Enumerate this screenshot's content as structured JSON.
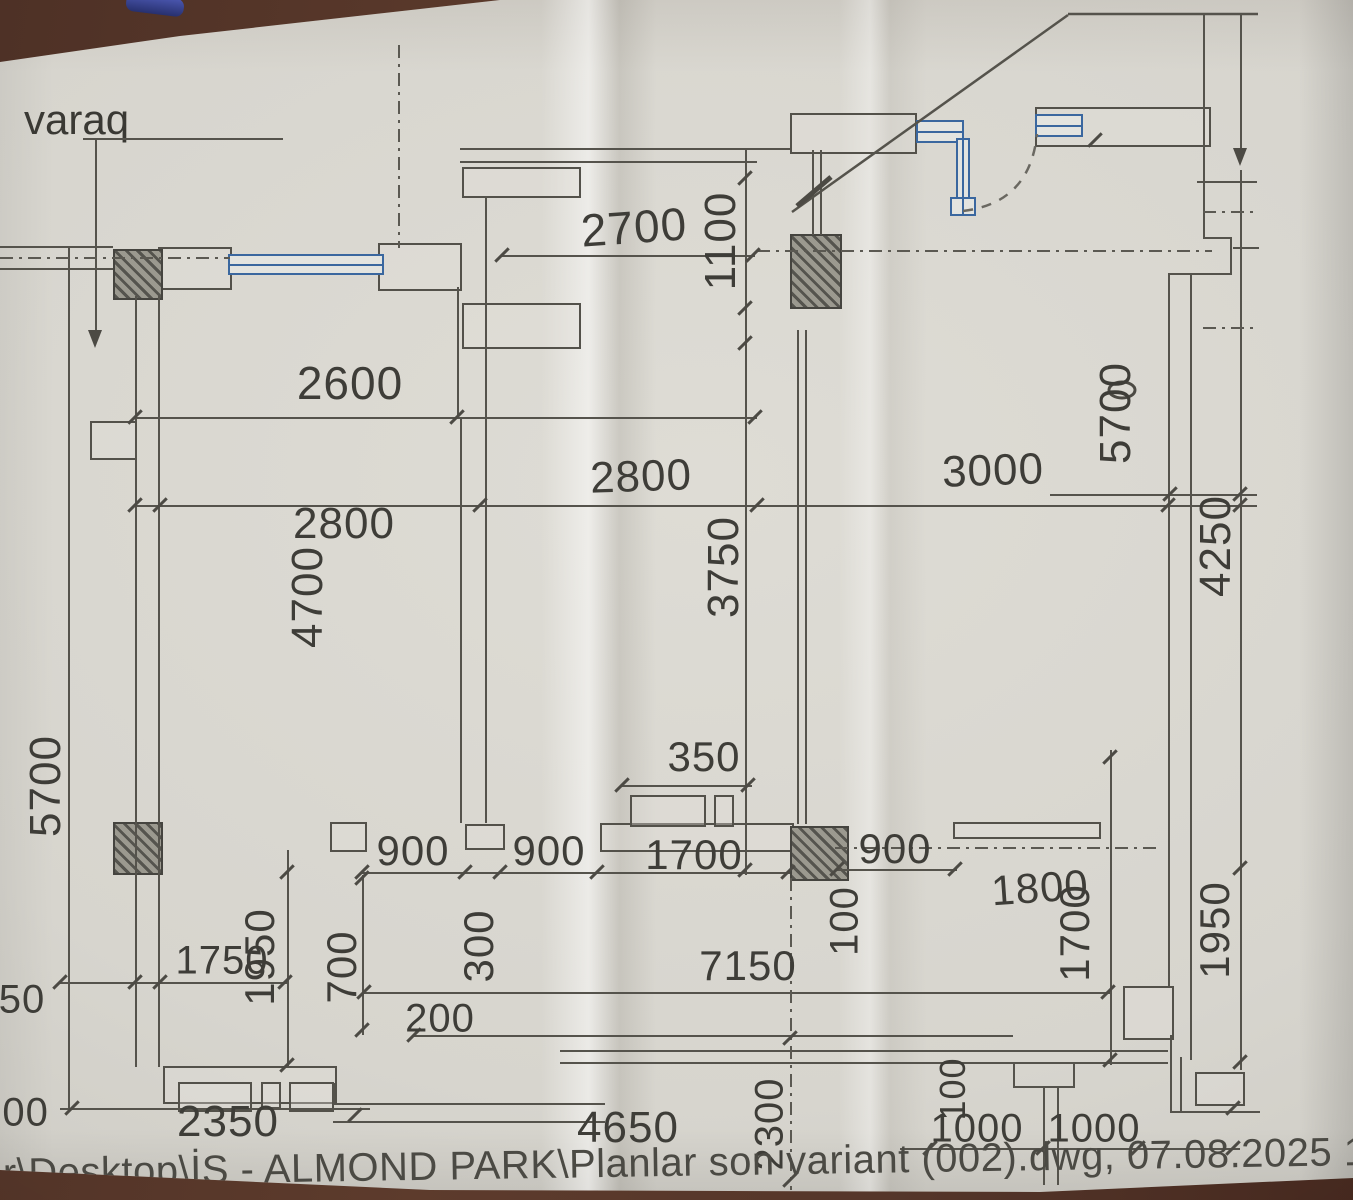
{
  "sheet": {
    "label": "varaq",
    "footer": "er\\Desktop\\İŞ - ALMOND PARK\\Planlar son variant (002).dwg, 07.08.2025 12:28:03, VersaLink C7130 Color M"
  },
  "colors": {
    "paper": "#d7d5ce",
    "table": "#5d3b2c",
    "line": "#55534c",
    "text": "#3e3d38",
    "window_blue": "#3a679f"
  },
  "dimensions": [
    {
      "text": "2700",
      "x": 634,
      "y": 227,
      "rot": -4,
      "size": 46
    },
    {
      "text": "1100",
      "x": 721,
      "y": 241,
      "rot": -90,
      "size": 44
    },
    {
      "text": "2600",
      "x": 350,
      "y": 383,
      "rot": 0,
      "size": 46
    },
    {
      "text": "2800",
      "x": 344,
      "y": 524,
      "rot": 0,
      "size": 44
    },
    {
      "text": "4700",
      "x": 308,
      "y": 597,
      "rot": -90,
      "size": 44
    },
    {
      "text": "2800",
      "x": 641,
      "y": 477,
      "rot": -2,
      "size": 44
    },
    {
      "text": "3000",
      "x": 993,
      "y": 471,
      "rot": -2,
      "size": 44
    },
    {
      "text": "3750",
      "x": 724,
      "y": 567,
      "rot": -90,
      "size": 44
    },
    {
      "text": "5700",
      "x": 46,
      "y": 786,
      "rot": -90,
      "size": 44
    },
    {
      "text": "5700",
      "x": 1116,
      "y": 413,
      "rot": -90,
      "size": 44
    },
    {
      "text": "4250",
      "x": 1216,
      "y": 546,
      "rot": -90,
      "size": 44
    },
    {
      "text": "350",
      "x": 704,
      "y": 757,
      "rot": 0,
      "size": 42
    },
    {
      "text": "900",
      "x": 413,
      "y": 851,
      "rot": 0,
      "size": 42
    },
    {
      "text": "900",
      "x": 549,
      "y": 851,
      "rot": 0,
      "size": 42
    },
    {
      "text": "1700",
      "x": 694,
      "y": 855,
      "rot": 0,
      "size": 42
    },
    {
      "text": "900",
      "x": 895,
      "y": 849,
      "rot": 0,
      "size": 42
    },
    {
      "text": "1800",
      "x": 1040,
      "y": 888,
      "rot": -4,
      "size": 42
    },
    {
      "text": "100",
      "x": 845,
      "y": 921,
      "rot": -90,
      "size": 40
    },
    {
      "text": "1700",
      "x": 1075,
      "y": 933,
      "rot": -90,
      "size": 42
    },
    {
      "text": "1950",
      "x": 1215,
      "y": 930,
      "rot": -90,
      "size": 42
    },
    {
      "text": "1750",
      "x": 222,
      "y": 961,
      "rot": 0,
      "size": 40
    },
    {
      "text": "1950",
      "x": 260,
      "y": 957,
      "rot": -90,
      "size": 42
    },
    {
      "text": "700",
      "x": 342,
      "y": 967,
      "rot": -90,
      "size": 42
    },
    {
      "text": "300",
      "x": 479,
      "y": 946,
      "rot": -90,
      "size": 42
    },
    {
      "text": "7150",
      "x": 748,
      "y": 966,
      "rot": 0,
      "size": 42
    },
    {
      "text": "200",
      "x": 440,
      "y": 1019,
      "rot": 0,
      "size": 40
    },
    {
      "text": "2350",
      "x": 228,
      "y": 1122,
      "rot": 0,
      "size": 44
    },
    {
      "text": "4650",
      "x": 628,
      "y": 1128,
      "rot": 0,
      "size": 44
    },
    {
      "text": "2300",
      "x": 770,
      "y": 1124,
      "rot": -90,
      "size": 40
    },
    {
      "text": "100",
      "x": 953,
      "y": 1089,
      "rot": -90,
      "size": 36
    },
    {
      "text": "1000",
      "x": 977,
      "y": 1129,
      "rot": 0,
      "size": 40
    },
    {
      "text": "1000",
      "x": 1094,
      "y": 1129,
      "rot": 0,
      "size": 40
    },
    {
      "text": "100",
      "x": 14,
      "y": 1113,
      "rot": 0,
      "size": 40
    },
    {
      "text": "50",
      "x": 22,
      "y": 1000,
      "rot": 0,
      "size": 40
    }
  ]
}
